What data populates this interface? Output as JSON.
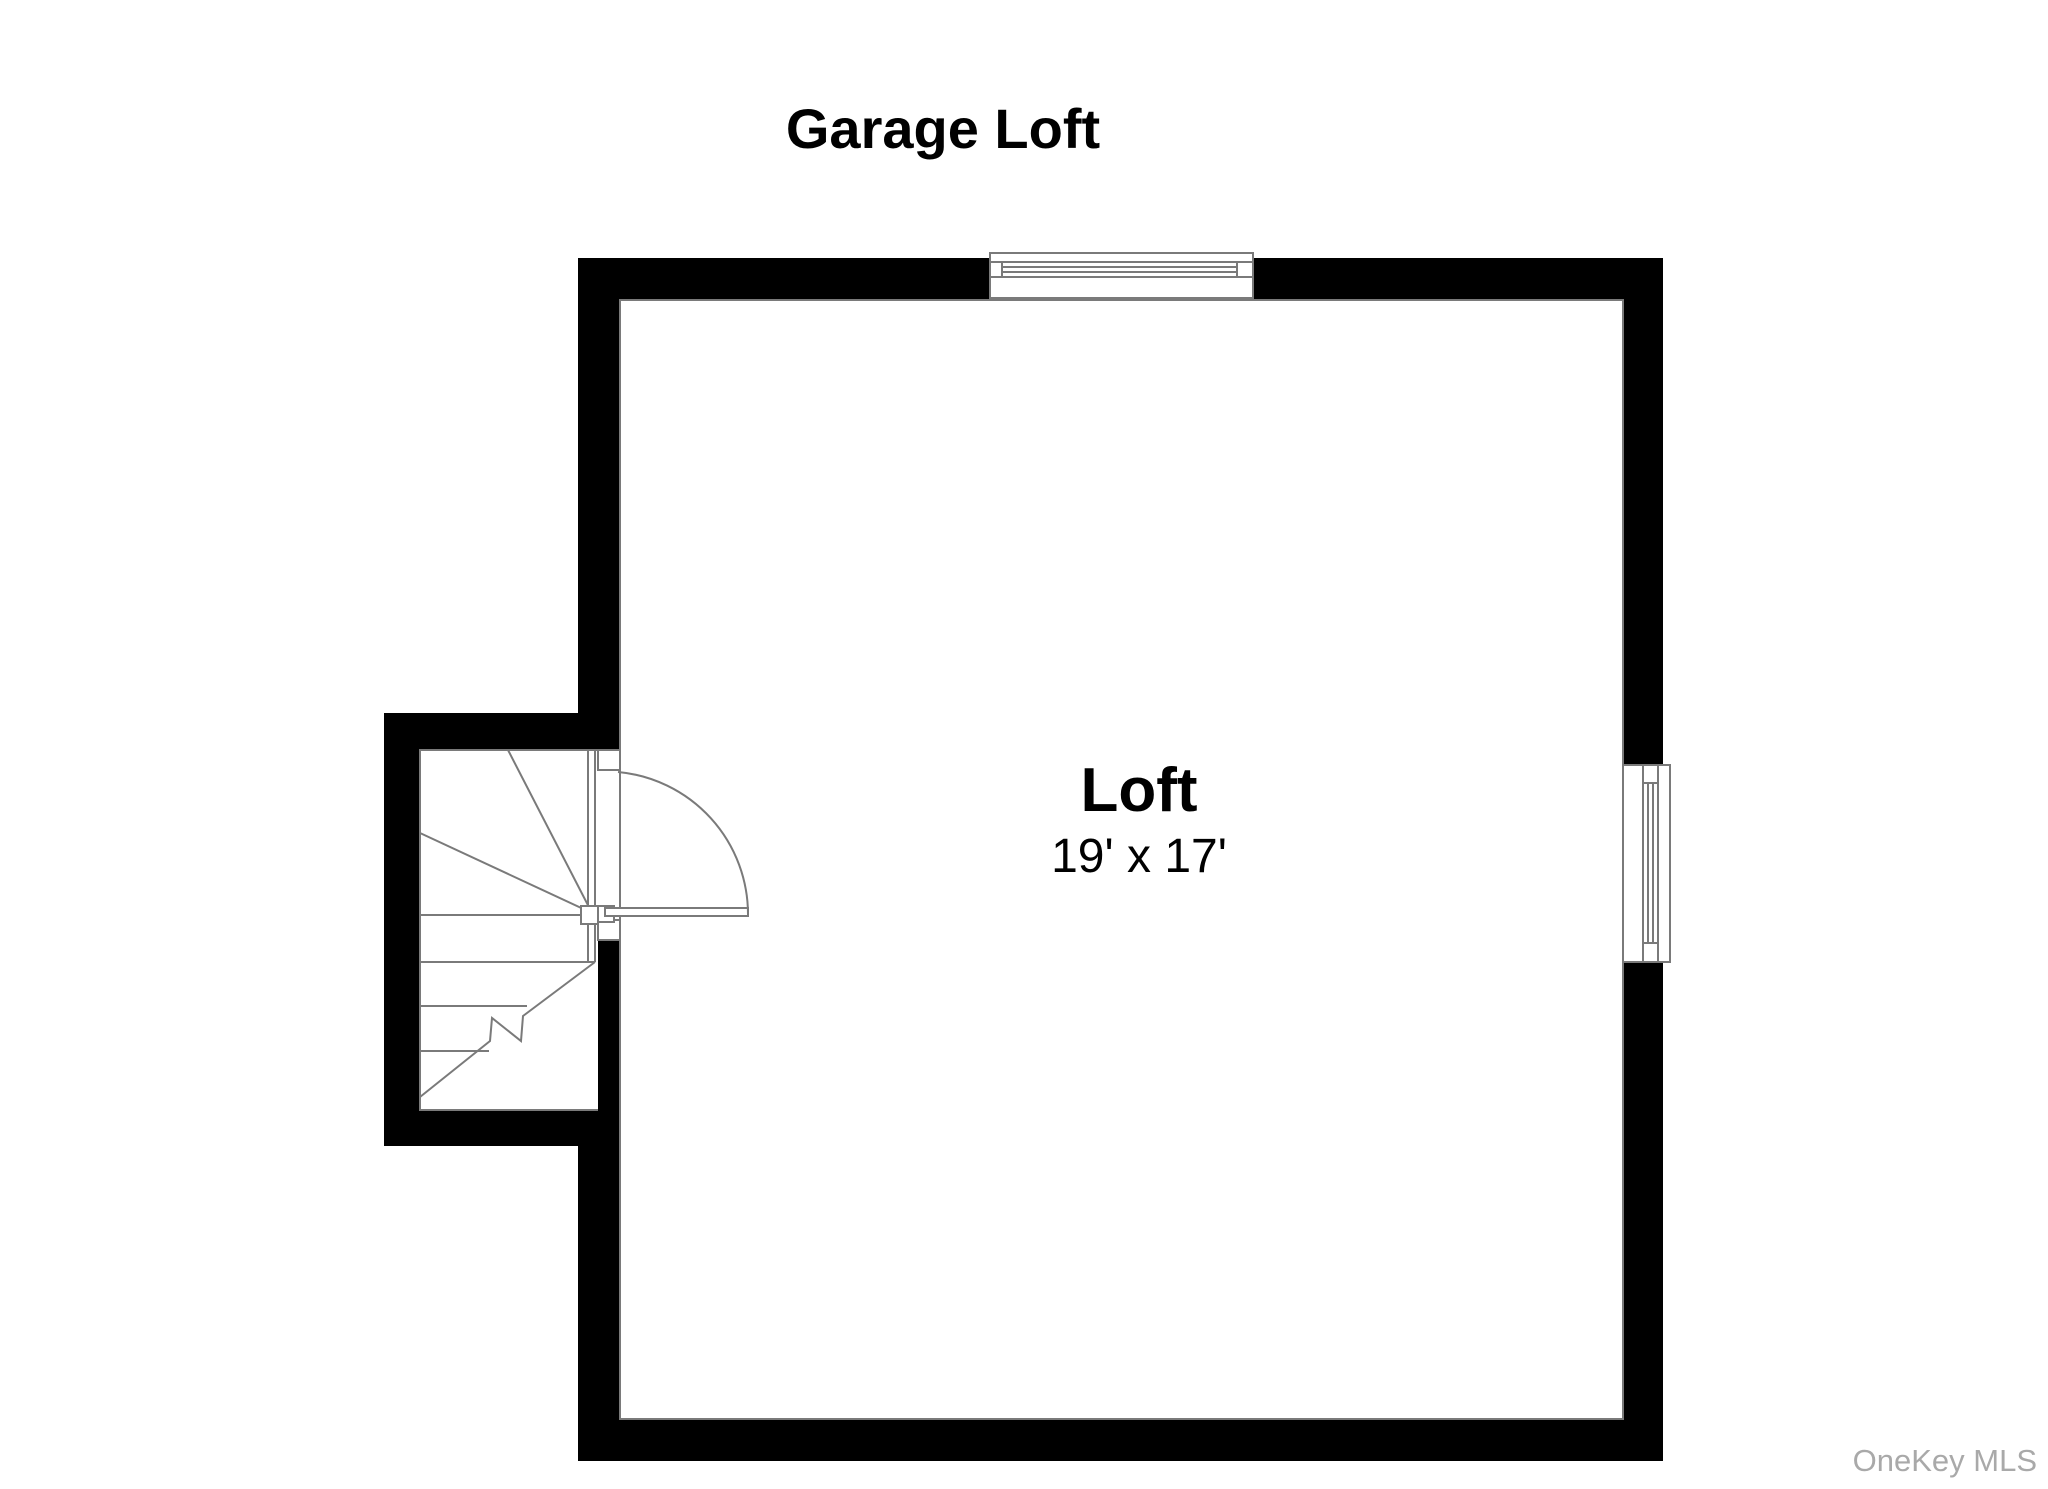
{
  "title": "Garage Loft",
  "room": {
    "name": "Loft",
    "dimensions": "19' x 17'"
  },
  "watermark": "OneKey MLS",
  "colors": {
    "background": "#ffffff",
    "wall": "#000000",
    "line": "#7a7a7a",
    "text": "#000000",
    "watermark": "#a9a9a9"
  }
}
